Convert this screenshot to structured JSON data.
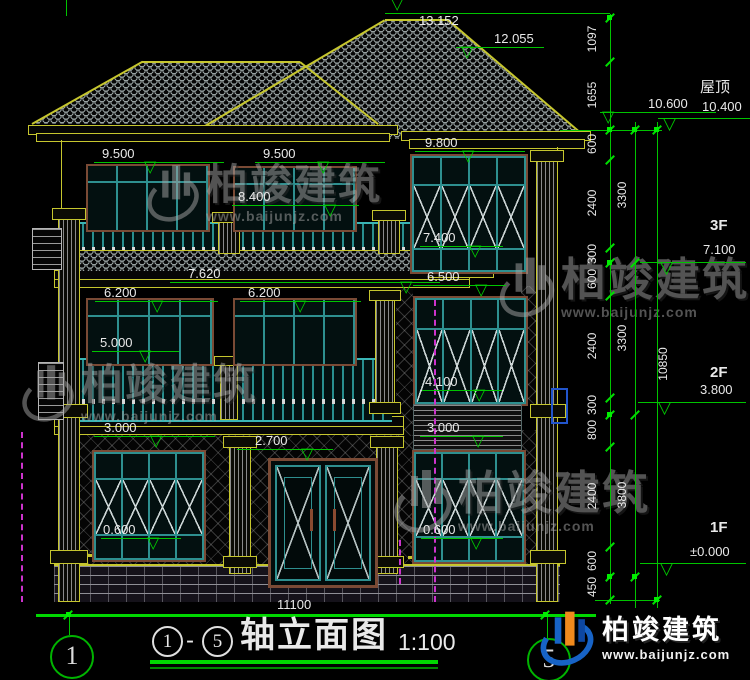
{
  "watermark": {
    "brand": "柏竣建筑",
    "url": "www.baijunjz.com"
  },
  "logo": {
    "brand": "柏竣建筑",
    "url": "www.baijunjz.com"
  },
  "title": {
    "axis_start": "1",
    "axis_end": "5",
    "dash": "-",
    "name": "轴立面图",
    "scale": "1:100"
  },
  "axes": {
    "left": "1",
    "right": "5"
  },
  "ground": {
    "width": "11100"
  },
  "levels": {
    "ridge": "13.152",
    "ridge2": "12.055",
    "eave_high": "10.600",
    "roof_label": "屋顶",
    "roof": "10.400",
    "f3_label": "3F",
    "f3": "7.100",
    "f2_label": "2F",
    "f2": "3.800",
    "f1_label": "1F",
    "f1": "±0.000"
  },
  "marks": {
    "m9800": "9.800",
    "m9500a": "9.500",
    "m9500b": "9.500",
    "m8400": "8.400",
    "m7620": "7.620",
    "m7400": "7.400",
    "m6500": "6.500",
    "m6200a": "6.200",
    "m6200b": "6.200",
    "m5000": "5.000",
    "m4100": "4.100",
    "m3000a": "3.000",
    "m3000b": "3.000",
    "m2700": "2.700",
    "m0600a": "0.600",
    "m0600b": "0.600"
  },
  "dims": {
    "right_col1": [
      "1097",
      "1655",
      "600",
      "2400",
      "300",
      "600",
      "2400",
      "300",
      "800",
      "2400",
      "600",
      "450"
    ],
    "right_col2": [
      "3300",
      "3300",
      "3800"
    ],
    "overall": "10850"
  }
}
